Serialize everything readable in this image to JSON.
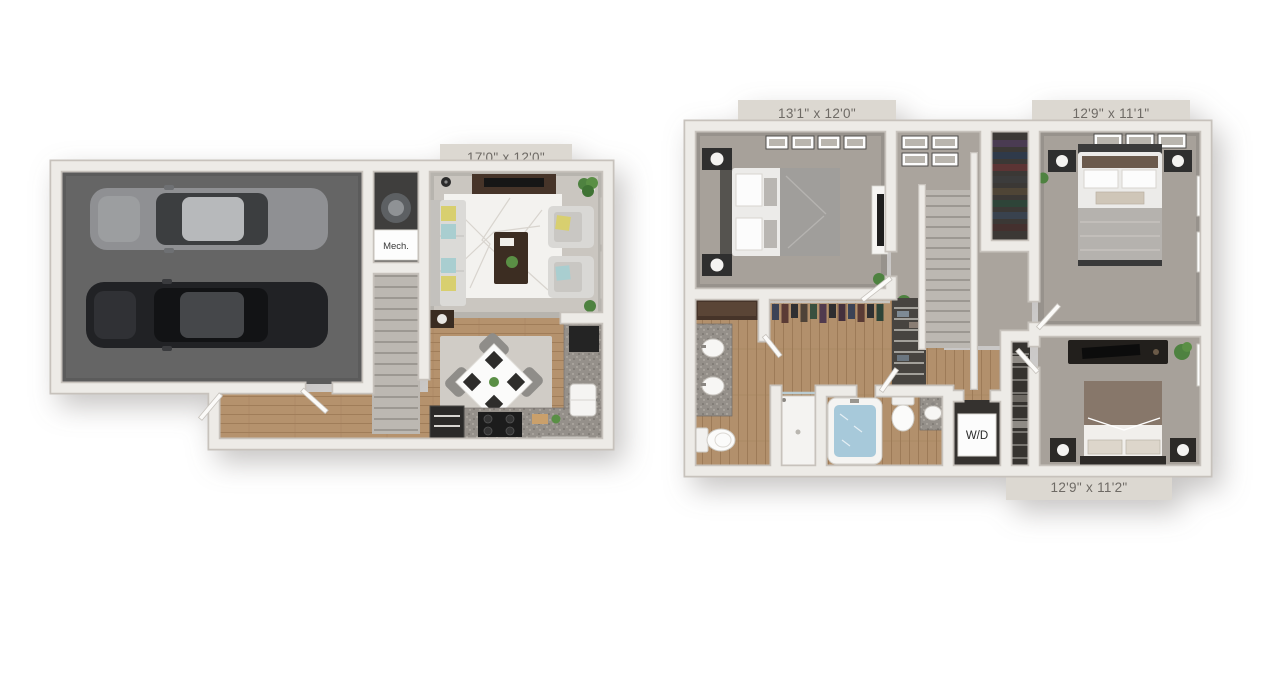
{
  "first_floor": {
    "dimension_label": "17'0\" x 12'0\"",
    "mech_label": "Mech."
  },
  "second_floor": {
    "primary_dimension_label": "13'1\" x 12'0\"",
    "bedroom2_dimension_label": "12'9\" x 11'1\"",
    "bedroom3_dimension_label": "12'9\" x 11'2\"",
    "washer_dryer_label": "W/D"
  },
  "colors": {
    "background": "#ffffff",
    "wall": "#edebe7",
    "wall_shadow": "#c7c2bc",
    "garage_floor": "#656565",
    "living_carpet": "#cac6c0",
    "bedroom_carpet": "#a7a19a",
    "hall_carpet": "#aaa49d",
    "wood_floor": "#b5926d",
    "granite_counter": "#95908a",
    "dark_wood_furniture": "#46342a",
    "sofa_gray": "#dbdad7",
    "accent_pillow_yellow": "#d8cf6f",
    "accent_pillow_teal": "#a9ced0",
    "plant_green": "#5a8f45",
    "bath_water": "#a7c9da",
    "label_background": "#dcd8d1",
    "label_text": "#6e6a65"
  }
}
